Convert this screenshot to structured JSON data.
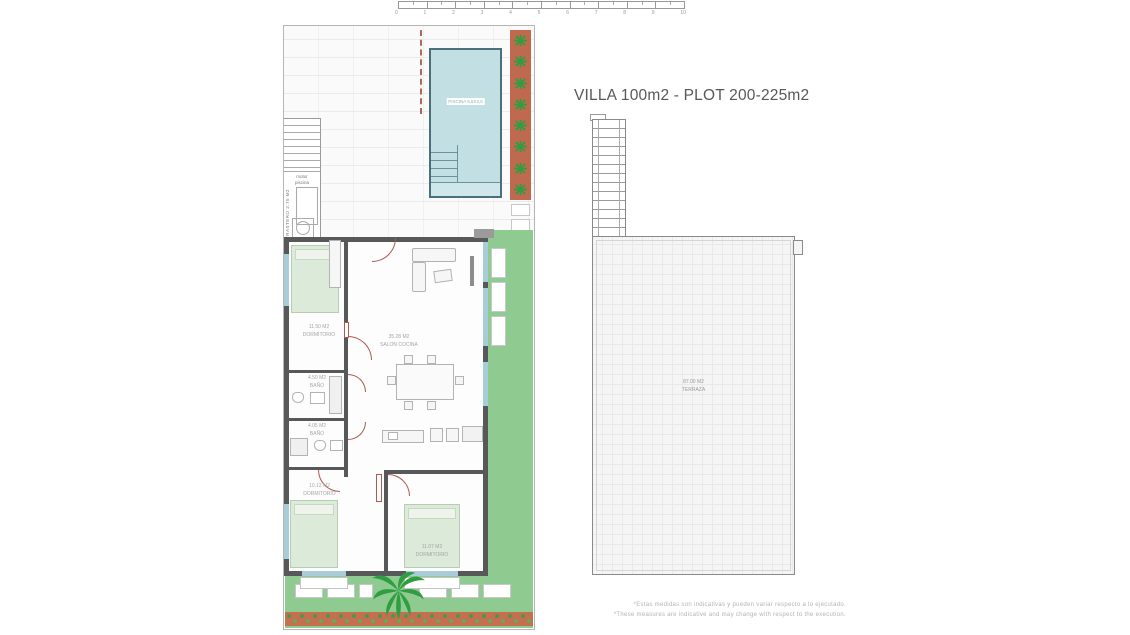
{
  "title": "VILLA 100m2 - PLOT 200-225m2",
  "scale_bar": {
    "ticks": [
      "0",
      "1",
      "2",
      "3",
      "4",
      "5",
      "6",
      "7",
      "8",
      "9",
      "10"
    ]
  },
  "site_plan": {
    "pool_label": "PISCINA 6,5X2,5",
    "pump_room": {
      "line1": "motor",
      "line2": "piscina"
    },
    "storage_label": "TRASTERO 2.75 M2",
    "rooms": {
      "bedroom1": {
        "area": "11.50 M2",
        "name": "DORMITORIO"
      },
      "living": {
        "area": "35.28 M2",
        "name": "SALON COCINA"
      },
      "bath1": {
        "area": "4.50 M2",
        "name": "BAÑO"
      },
      "bath2": {
        "area": "4.05 M2",
        "name": "BAÑO"
      },
      "bedroom2": {
        "area": "10.12 M2",
        "name": "DORMITORIO"
      },
      "bedroom3": {
        "area": "11.07 M2",
        "name": "DORMITORIO"
      }
    }
  },
  "roof_plan": {
    "terrace": {
      "area": "87.00 M2",
      "name": "TERRAZA"
    }
  },
  "footnote": {
    "line1": "*Estas medidas son indicativas y pueden variar respecto a lo ejecutado.",
    "line2": "*These measures are indicative and may change with respect to the execution."
  },
  "colors": {
    "wall": "#57585a",
    "pool": "#c2dfe4",
    "pool_border": "#49707c",
    "lawn": "#8fca90",
    "flowerbed": "#c46f50",
    "plant_green": "#2f9e41",
    "door": "#ad5a50",
    "window": "#a9ccd9",
    "bed": "#dcead9",
    "label_text": "#9a9a9a"
  }
}
